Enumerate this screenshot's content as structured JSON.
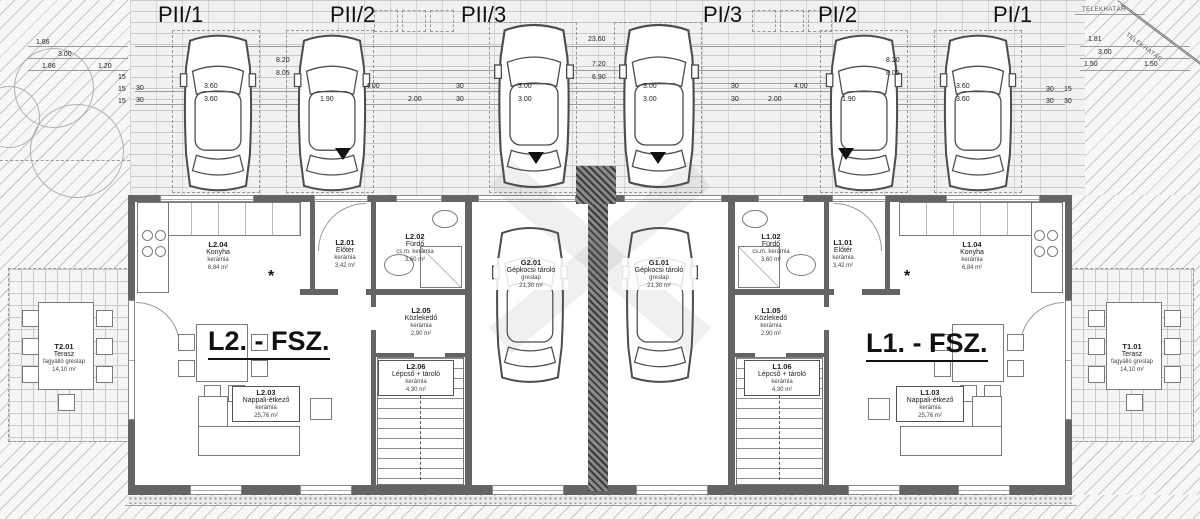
{
  "site": {
    "boundary_label_top": "TELEKHATÁR",
    "boundary_label_diagonal": "TELEKHATÁR"
  },
  "parking_labels": [
    "PII/1",
    "PII/2",
    "PII/3",
    "PI/3",
    "PI/2",
    "PI/1"
  ],
  "unit_labels": {
    "left": "L2. - FSZ.",
    "right": "L1. - FSZ."
  },
  "symbols": {
    "asterisk": "*"
  },
  "rooms": [
    {
      "code": "L2.04",
      "name": "Konyha",
      "material": "kerámia",
      "area": "6,84 m²"
    },
    {
      "code": "L2.01",
      "name": "Előtér",
      "material": "kerámia",
      "area": "3,42 m²"
    },
    {
      "code": "L2.02",
      "name": "Fürdő",
      "material": "cs.m. kerámia",
      "area": "3,60 m²"
    },
    {
      "code": "G2.01",
      "name": "Gépkocsi tároló",
      "material": "greslap",
      "area": "21,30 m²"
    },
    {
      "code": "G1.01",
      "name": "Gépkocsi tároló",
      "material": "greslap",
      "area": "21,30 m²"
    },
    {
      "code": "L1.02",
      "name": "Fürdő",
      "material": "cs.m. kerámia",
      "area": "3,60 m²"
    },
    {
      "code": "L1.01",
      "name": "Előtér",
      "material": "kerámia",
      "area": "3,42 m²"
    },
    {
      "code": "L1.04",
      "name": "Konyha",
      "material": "kerámia",
      "area": "6,84 m²"
    },
    {
      "code": "L2.05",
      "name": "Közlekedő",
      "material": "kerámia",
      "area": "2,90 m²"
    },
    {
      "code": "L1.05",
      "name": "Közlekedő",
      "material": "kerámia",
      "area": "2,90 m²"
    },
    {
      "code": "L2.06",
      "name": "Lépcső + tároló",
      "material": "kerámia",
      "area": "4,30 m²"
    },
    {
      "code": "L1.06",
      "name": "Lépcső + tároló",
      "material": "kerámia",
      "area": "4,30 m²"
    },
    {
      "code": "L2.03",
      "name": "Nappali-étkező",
      "material": "kerámia",
      "area": "25,76 m²"
    },
    {
      "code": "L1.03",
      "name": "Nappali-étkező",
      "material": "kerámia",
      "area": "25,76 m²"
    },
    {
      "code": "T2.01",
      "name": "Terasz",
      "material": "fagyálló greslap",
      "area": "14,10 m²"
    },
    {
      "code": "T1.01",
      "name": "Terasz",
      "material": "fagyálló greslap",
      "area": "14,10 m²"
    }
  ],
  "dims": [
    "23.60",
    "7.20",
    "6.90",
    "8.20",
    "8.05",
    "3.60",
    "3.60",
    "1.90",
    "2.00",
    "4.00",
    "3.00",
    "3.00",
    "3.00",
    "3.00",
    "4.00",
    "2.00",
    "1.90",
    "3.60",
    "3.60",
    "8.20",
    "8.05",
    "1.86",
    "3.00",
    "1.86",
    "1.20",
    "1.81",
    "3.00",
    "1.50",
    "1.50",
    "15",
    "30",
    "15",
    "30",
    "15",
    "30",
    "15",
    "30",
    "30",
    "30",
    "30",
    "30",
    "30"
  ]
}
